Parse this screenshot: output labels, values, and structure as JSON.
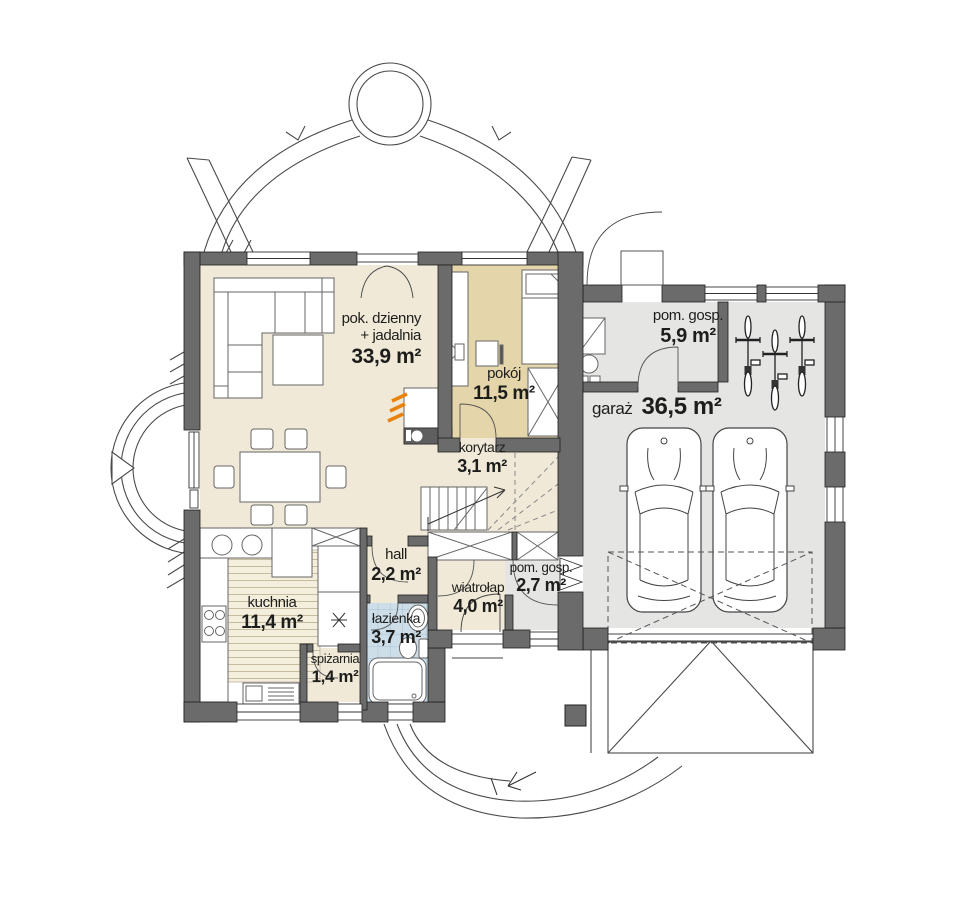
{
  "rooms": {
    "living": {
      "name": "pok. dzienny",
      "name2": "+ jadalnia",
      "area": "33,9 m²"
    },
    "pokoj": {
      "name": "pokój",
      "area": "11,5 m²"
    },
    "korytarz": {
      "name": "korytarz",
      "area": "3,1 m²"
    },
    "hall": {
      "name": "hall",
      "area": "2,2 m²"
    },
    "lazienka": {
      "name": "łazienka",
      "area": "3,7 m²"
    },
    "kuchnia": {
      "name": "kuchnia",
      "area": "11,4 m²"
    },
    "spizarnia": {
      "name": "spiżarnia",
      "area": "1,4 m²"
    },
    "wiatrolap": {
      "name": "wiatrołap",
      "area": "4,0 m²"
    },
    "pom_gosp_maly": {
      "name": "pom. gosp.",
      "area": "2,7 m²"
    },
    "pom_gosp": {
      "name": "pom. gosp.",
      "area": "5,9 m²"
    },
    "garaz": {
      "name": "garaż",
      "area": "36,5 m²"
    }
  },
  "colors": {
    "wall": "#6b6b6b",
    "floor_beige": "#f0e9d8",
    "floor_tan": "#e4d5ab",
    "floor_gray": "#e5e5e4",
    "tile_blue": "#cddee9",
    "flame_orange": "#e8820c",
    "line_dark": "#3d3d3d"
  }
}
